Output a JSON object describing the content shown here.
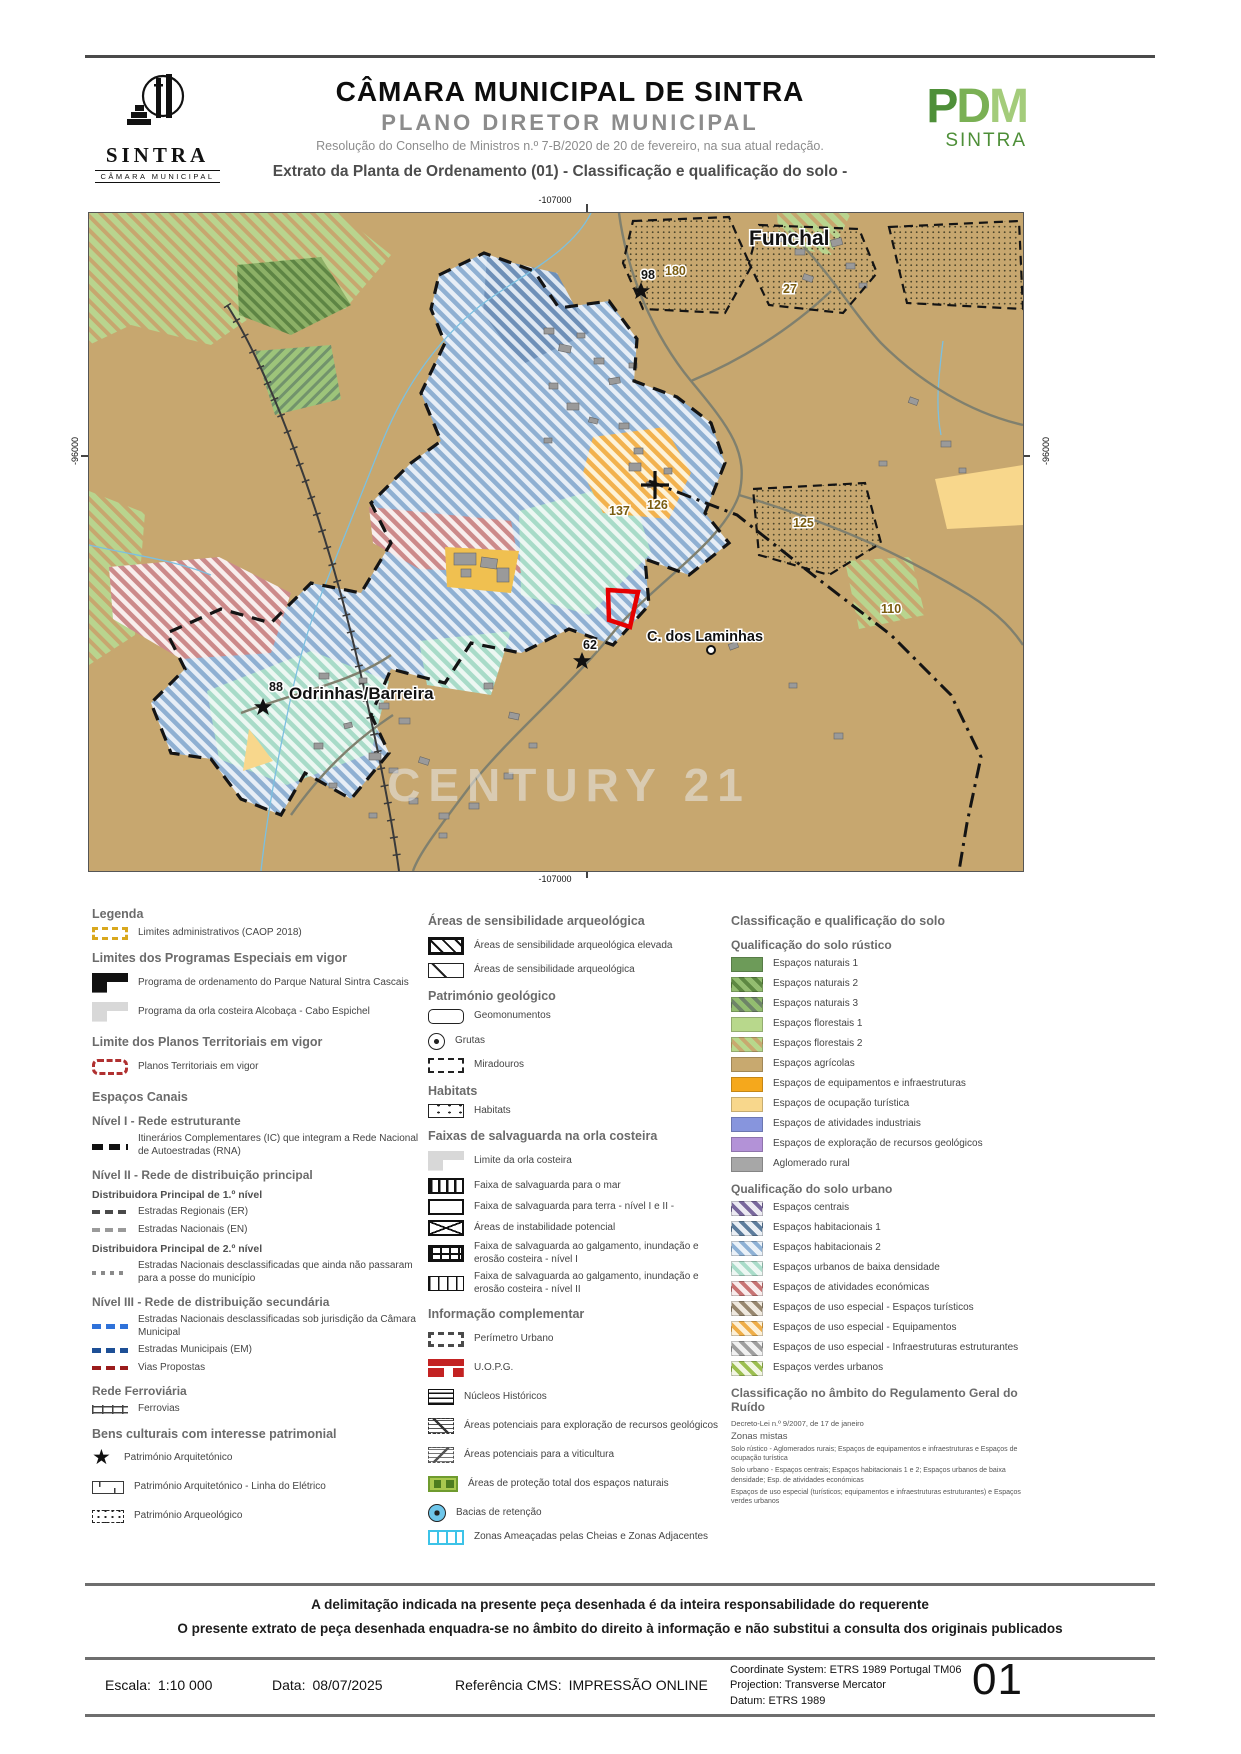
{
  "header": {
    "org": "CÂMARA MUNICIPAL DE SINTRA",
    "plan": "PLANO DIRETOR MUNICIPAL",
    "resolution": "Resolução do Conselho de Ministros n.º 7-B/2020 de 20 de fevereiro, na sua atual redação.",
    "extract_title": "Extrato da Planta de Ordenamento (01) - Classificação e qualificação do solo -",
    "logo": {
      "name": "SINTRA",
      "sub": "CÂMARA MUNICIPAL"
    },
    "pdm_logo": {
      "p": "P",
      "d": "D",
      "m": "M",
      "name": "SINTRA"
    }
  },
  "map": {
    "coords": {
      "top": "-107000",
      "bottom": "-107000",
      "left": "-96000",
      "right": "-96000"
    },
    "places": {
      "funchal": "Funchal",
      "odrinhas": "Odrinhas/Barreira",
      "laminhas": "C. dos Laminhas"
    },
    "sites": {
      "s98": "98",
      "s180": "180",
      "s27": "27",
      "s125": "125",
      "s110": "110",
      "s137": "137",
      "s126": "126",
      "s62": "62",
      "s88": "88"
    },
    "watermark": "CENTURY 21",
    "colors": {
      "agricolas": "#c7a76f",
      "habitacionais2": "#8fb0d2",
      "baixa_densidade": "#a8dbc8",
      "economicas": "#cc8a8a",
      "equipamentos": "#f2b24e",
      "parcel_outline": "#e60000"
    }
  },
  "legend": {
    "columns": [
      {
        "id": "limites",
        "rows": [
          {
            "t": "h1",
            "text": "Legenda"
          },
          {
            "t": "item",
            "label": "Limites administrativos (CAOP 2018)",
            "swatch": "admin"
          },
          {
            "t": "h1",
            "text": "Limites dos Programas Especiais em vigor"
          },
          {
            "t": "item",
            "label": "Programa de ordenamento do Parque Natural Sintra Cascais",
            "swatch": "pnsc",
            "tall": true
          },
          {
            "t": "item",
            "label": "Programa da orla costeira Alcobaça - Cabo Espichel",
            "swatch": "orla",
            "tall": true
          },
          {
            "t": "h1",
            "text": "Limite dos Planos Territoriais em vigor"
          },
          {
            "t": "item",
            "label": "Planos Territoriais em vigor",
            "swatch": "planos",
            "tall": true
          },
          {
            "t": "h1",
            "text": "Espaços Canais"
          },
          {
            "t": "h2",
            "text": "Nível I - Rede estruturante"
          },
          {
            "t": "item",
            "label": "Itinerários Complementares (IC) que integram a Rede Nacional de Autoestradas (RNA)",
            "swatch": "ic"
          },
          {
            "t": "h2",
            "text": "Nível II - Rede de distribuição principal"
          },
          {
            "t": "sub",
            "text": "Distribuidora Principal de 1.º nível"
          },
          {
            "t": "item",
            "label": "Estradas Regionais (ER)",
            "swatch": "er"
          },
          {
            "t": "item",
            "label": "Estradas Nacionais (EN)",
            "swatch": "en"
          },
          {
            "t": "sub",
            "text": "Distribuidora Principal de 2.º nível"
          },
          {
            "t": "item",
            "label": "Estradas Nacionais desclassificadas que ainda não passaram para a posse do município",
            "swatch": "en2"
          },
          {
            "t": "h2",
            "text": "Nível III - Rede de distribuição secundária"
          },
          {
            "t": "item",
            "label": "Estradas Nacionais desclassificadas sob jurisdição da Câmara Municipal",
            "swatch": "ncm"
          },
          {
            "t": "item",
            "label": "Estradas Municipais (EM)",
            "swatch": "em"
          },
          {
            "t": "item",
            "label": "Vias Propostas",
            "swatch": "vias"
          },
          {
            "t": "h2",
            "text": "Rede Ferroviária"
          },
          {
            "t": "item",
            "label": "Ferrovias",
            "swatch": "rail"
          },
          {
            "t": "h1",
            "text": "Bens culturais com interesse patrimonial"
          },
          {
            "t": "item",
            "label": "Património Arquitetónico",
            "swatch": "star",
            "tall": true
          },
          {
            "t": "item",
            "label": "Património Arquitetónico - Linha do Elétrico",
            "swatch": "tram",
            "tall": true
          },
          {
            "t": "item",
            "label": "Património Arqueológico",
            "swatch": "arqueo",
            "tall": true
          }
        ]
      },
      {
        "id": "arqueologia",
        "rows": [
          {
            "t": "h1",
            "text": "Áreas de sensibilidade arqueológica"
          },
          {
            "t": "item",
            "label": "Áreas de sensibilidade arqueológica elevada",
            "swatch": "arq-elev",
            "tall": true
          },
          {
            "t": "item",
            "label": "Áreas de sensibilidade arqueológica",
            "swatch": "arq"
          },
          {
            "t": "h1",
            "text": "Património geológico"
          },
          {
            "t": "item",
            "label": "Geomonumentos",
            "swatch": "geomon"
          },
          {
            "t": "item",
            "label": "Grutas",
            "swatch": "grutas",
            "tall": true
          },
          {
            "t": "item",
            "label": "Miradouros",
            "swatch": "mirad"
          },
          {
            "t": "h1",
            "text": "Habitats"
          },
          {
            "t": "item",
            "label": "Habitats",
            "swatch": "habitats"
          },
          {
            "t": "h1",
            "text": "Faixas de salvaguarda na orla costeira"
          },
          {
            "t": "item",
            "label": "Limite da orla costeira",
            "swatch": "orla-lim",
            "tall": true
          },
          {
            "t": "item",
            "label": "Faixa de salvaguarda para o mar",
            "swatch": "fx-mar"
          },
          {
            "t": "item",
            "label": "Faixa de salvaguarda para terra - nível I e II -",
            "swatch": "fx-terra"
          },
          {
            "t": "item",
            "label": "Áreas de instabilidade potencial",
            "swatch": "instab"
          },
          {
            "t": "item",
            "label": "Faixa de salvaguarda ao galgamento, inundação e erosão costeira - nível I",
            "swatch": "fx-galg1"
          },
          {
            "t": "item",
            "label": "Faixa de salvaguarda ao galgamento, inundação e erosão costeira - nível II",
            "swatch": "fx-galg2"
          },
          {
            "t": "h1",
            "text": "Informação complementar"
          },
          {
            "t": "item",
            "label": "Perímetro Urbano",
            "swatch": "perim",
            "tall": true
          },
          {
            "t": "item",
            "label": "U.O.P.G.",
            "swatch": "uopg",
            "tall": true
          },
          {
            "t": "item",
            "label": "Núcleos Históricos",
            "swatch": "nucleos",
            "tall": true
          },
          {
            "t": "item",
            "label": "Áreas potenciais para exploração de recursos geológicos",
            "swatch": "rec-geo",
            "tall": true
          },
          {
            "t": "item",
            "label": "Áreas potenciais para a viticultura",
            "swatch": "vitic",
            "tall": true
          },
          {
            "t": "item",
            "label": "Áreas de proteção total dos espaços naturais",
            "swatch": "prot-nat",
            "tall": true
          },
          {
            "t": "item",
            "label": "Bacias de retenção",
            "swatch": "bacias",
            "tall": true
          },
          {
            "t": "item",
            "label": "Zonas Ameaçadas pelas Cheias e Zonas Adjacentes",
            "swatch": "cheias"
          }
        ]
      },
      {
        "id": "classificacao",
        "rows": [
          {
            "t": "h1",
            "text": "Classificação e qualificação do solo"
          },
          {
            "t": "h2",
            "text": "Qualificação do solo rústico"
          },
          {
            "t": "chip",
            "label": "Espaços naturais 1",
            "fill": "#6d9b59"
          },
          {
            "t": "chip",
            "label": "Espaços naturais 2",
            "fill": "#93bd70",
            "stripe": "#5d8842"
          },
          {
            "t": "chip",
            "label": "Espaços naturais 3",
            "fill": "#93bd70",
            "stripe": "#6e8468"
          },
          {
            "t": "chip",
            "label": "Espaços florestais 1",
            "fill": "#b8d88c"
          },
          {
            "t": "chip",
            "label": "Espaços florestais 2",
            "fill": "#b8d88c",
            "stripe": "#c8a96f"
          },
          {
            "t": "chip",
            "label": "Espaços agrícolas",
            "fill": "#c8a96f"
          },
          {
            "t": "chip",
            "label": "Espaços de equipamentos e infraestruturas",
            "fill": "#f5a81c"
          },
          {
            "t": "chip",
            "label": "Espaços de ocupação turística",
            "fill": "#f8d78c"
          },
          {
            "t": "chip",
            "label": "Espaços de atividades industriais",
            "fill": "#8795dd"
          },
          {
            "t": "chip",
            "label": "Espaços de exploração de recursos geológicos",
            "fill": "#b392d7"
          },
          {
            "t": "chip",
            "label": "Aglomerado rural",
            "fill": "#a7a7a7"
          },
          {
            "t": "h2",
            "text": "Qualificação do solo urbano"
          },
          {
            "t": "chip",
            "label": "Espaços centrais",
            "fill": "#eceaf2",
            "stripe": "#79689d"
          },
          {
            "t": "chip",
            "label": "Espaços habitacionais 1",
            "fill": "#e9eef4",
            "stripe": "#5d7d9d"
          },
          {
            "t": "chip",
            "label": "Espaços habitacionais 2",
            "fill": "#eaf1f8",
            "stripe": "#8eb1d5"
          },
          {
            "t": "chip",
            "label": "Espaços urbanos de baixa densidade",
            "fill": "#edf7f3",
            "stripe": "#a9dcc9"
          },
          {
            "t": "chip",
            "label": "Espaços de atividades económicas",
            "fill": "#f8ecec",
            "stripe": "#c87474"
          },
          {
            "t": "chip",
            "label": "Espaços de uso especial - Espaços turísticos",
            "fill": "#efe9df",
            "stripe": "#97876f"
          },
          {
            "t": "chip",
            "label": "Espaços de uso especial - Equipamentos",
            "fill": "#fdf0d6",
            "stripe": "#efae48"
          },
          {
            "t": "chip",
            "label": "Espaços de uso especial - Infraestruturas estruturantes",
            "fill": "#f1f1f1",
            "stripe": "#9f9f9f"
          },
          {
            "t": "chip",
            "label": "Espaços verdes urbanos",
            "fill": "#f2f6e2",
            "stripe": "#9cbf50"
          },
          {
            "t": "h2",
            "text": "Classificação no âmbito do Regulamento Geral do Ruído"
          },
          {
            "t": "note",
            "text": "Decreto-Lei n.º 9/2007, de 17 de janeiro"
          },
          {
            "t": "note2",
            "text": "Zonas mistas"
          },
          {
            "t": "fine",
            "text": "Solo rústico - Aglomerados rurais; Espaços de equipamentos e infraestruturas e Espaços de ocupação turística"
          },
          {
            "t": "fine",
            "text": "Solo urbano - Espaços centrais; Espaços habitacionais 1 e 2; Espaços urbanos de baixa densidade; Esp. de atividades económicas"
          },
          {
            "t": "fine",
            "text": "Espaços de uso especial (turísticos; equipamentos e infraestruturas estruturantes) e Espaços verdes urbanos"
          }
        ]
      }
    ]
  },
  "disclaimer": {
    "line1": "A delimitação indicada na presente peça desenhada é da inteira responsabilidade do requerente",
    "line2": "O presente extrato de peça desenhada enquadra-se no âmbito do direito à informação e não substitui a consulta dos originais publicados"
  },
  "footer": {
    "escala_label": "Escala:",
    "escala_value": "1:10 000",
    "data_label": "Data:",
    "data_value": "08/07/2025",
    "ref_label": "Referência CMS:",
    "ref_value": "IMPRESSÃO ONLINE",
    "coord_line1": "Coordinate System: ETRS 1989 Portugal TM06",
    "coord_line2": "Projection: Transverse Mercator",
    "coord_line3": "Datum: ETRS 1989",
    "page_number": "01"
  }
}
